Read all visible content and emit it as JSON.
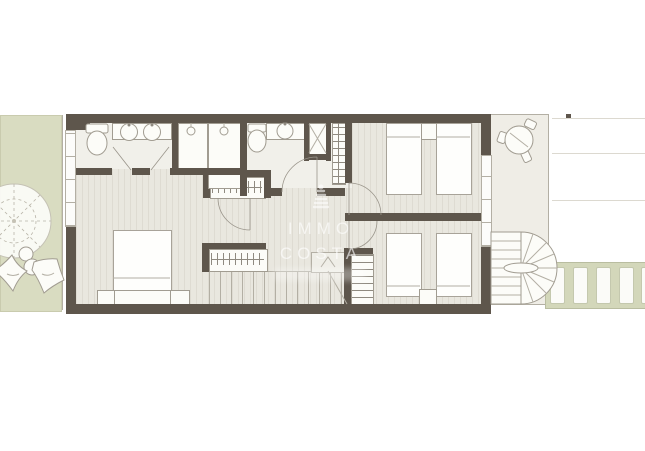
{
  "watermark": {
    "line1": "IMMO",
    "line2": "COSTA",
    "icon": "lighthouse-icon"
  },
  "colors": {
    "wall": "#5e564c",
    "floor": "#e9e7df",
    "floor_stripe": "#dedbd2",
    "bath_floor": "#f1f0ea",
    "garden": "#d9dcc1",
    "terrace": "#efede6",
    "pergola": "#d3d7ba",
    "outline": "#b3afa4",
    "fixture": "#a19c91"
  },
  "elements": {
    "fixtures": [
      "toilet",
      "double-sink-vanity",
      "single-sink-vanity",
      "shower",
      "shower-tray-x",
      "closet-shelves",
      "wardrobe-hanging-rail",
      "double-bed",
      "single-bed",
      "nightstand",
      "straight-staircase",
      "loft-ladder",
      "spiral-staircase",
      "outdoor-round-table-with-chairs",
      "pergola-beams",
      "garden-tree",
      "garden-shrubs"
    ]
  }
}
